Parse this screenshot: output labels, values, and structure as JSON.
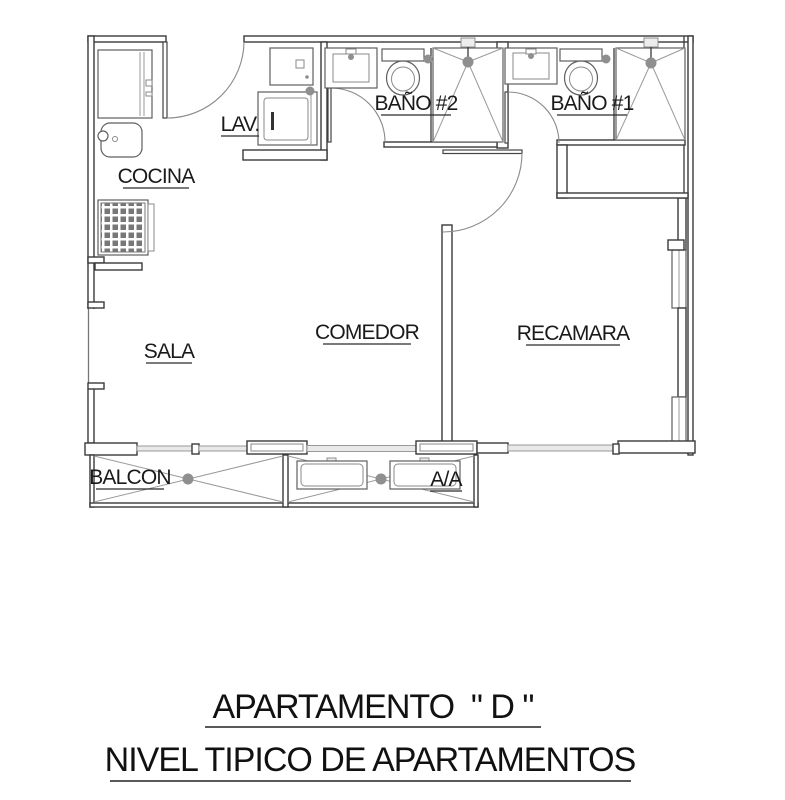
{
  "drawing": {
    "type": "apartment-floor-plan",
    "rooms": {
      "cocina": "COCINA",
      "lav": "LAV.",
      "bano2": "BAÑO #2",
      "bano1": "BAÑO #1",
      "sala": "SALA",
      "comedor": "COMEDOR",
      "recamara": "RECAMARA",
      "balcon": "BALCON",
      "aa": "A/A"
    },
    "title_line1": "APARTAMENTO  \" D \"",
    "title_line2": "NIVEL TIPICO DE APARTAMENTOS",
    "colors": {
      "background": "#ffffff",
      "wall": "#3a3a3a",
      "fixture": "#5f5f5f",
      "light_line": "#9a9a9a",
      "text": "#1a1a1a"
    }
  }
}
